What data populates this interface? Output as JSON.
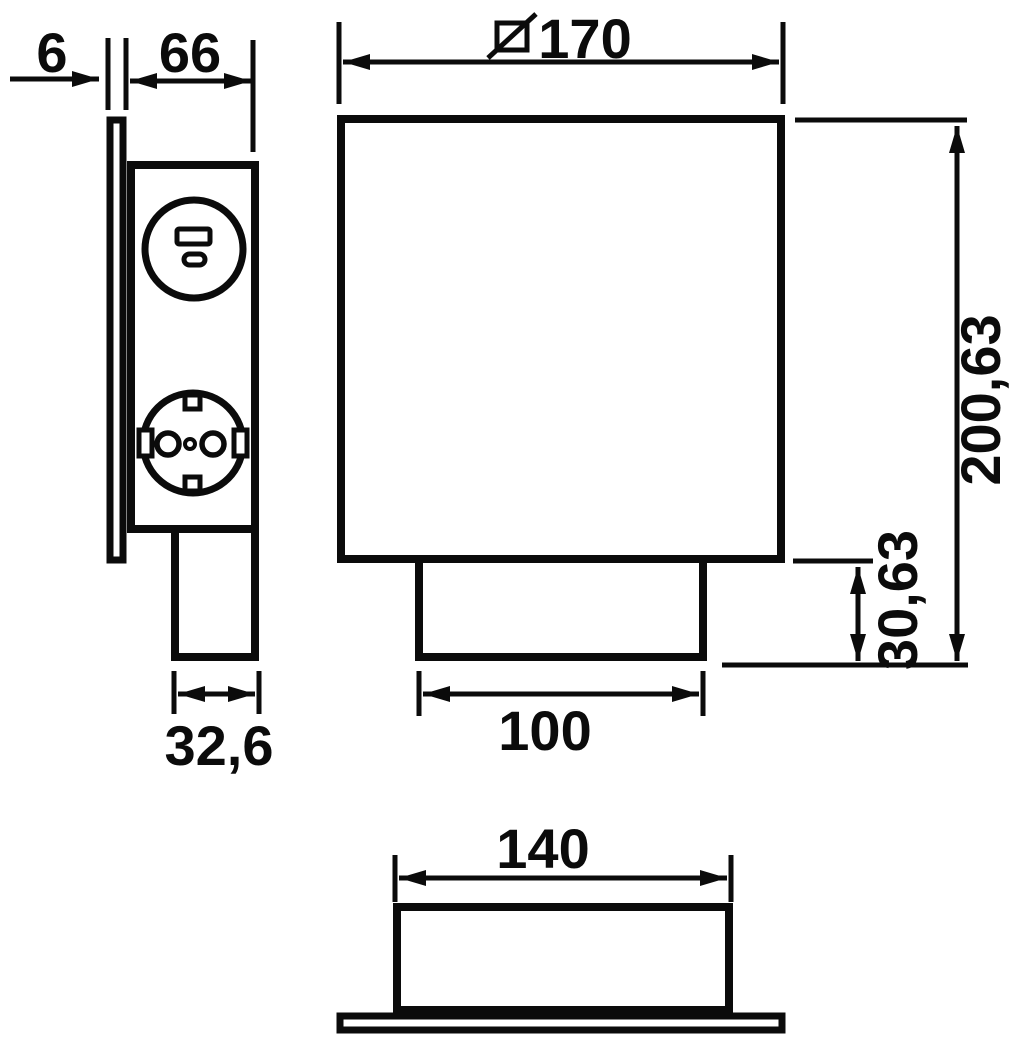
{
  "drawing": {
    "background_color": "#ffffff",
    "ink_color": "#0b0b0b",
    "dimensions": {
      "plate_thickness": "6",
      "housing_depth": "66",
      "stem_depth": "32,6",
      "front_width": "170",
      "front_width_symbol": "square-diagonal-slash-icon",
      "overall_height": "200,63",
      "stem_height": "30,63",
      "stem_width": "100",
      "base_box_width": "140"
    },
    "features": {
      "usb_socket": "usb-charging-socket-icon",
      "power_socket": "schuko-socket-icon"
    }
  }
}
